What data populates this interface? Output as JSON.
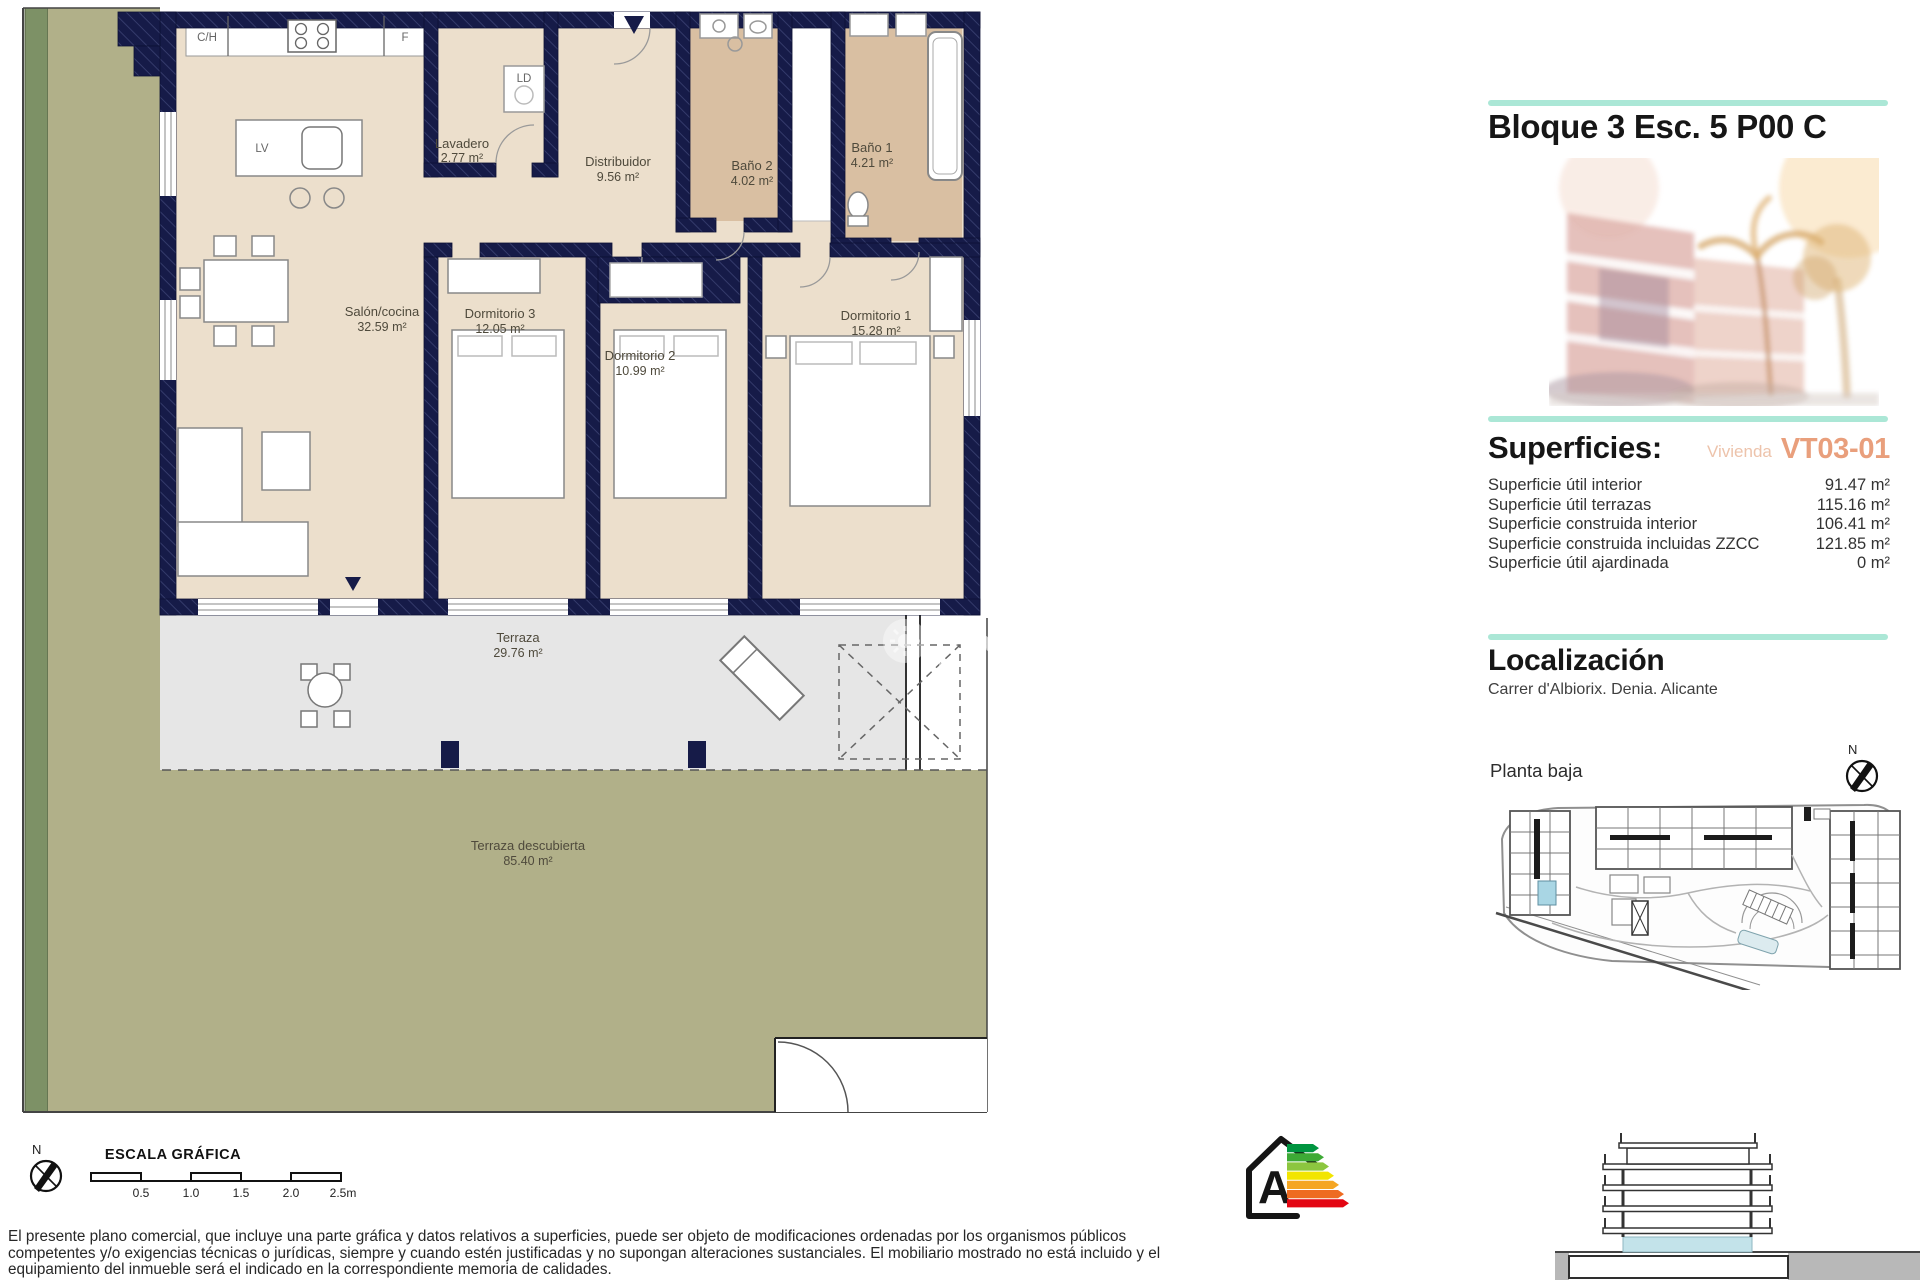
{
  "plan": {
    "rooms": [
      {
        "label": "Salón/cocina",
        "area": "32.59 m²"
      },
      {
        "label": "Dormitorio 3",
        "area": "12.05 m²"
      },
      {
        "label": "Dormitorio 2",
        "area": "10.99 m²"
      },
      {
        "label": "Dormitorio 1",
        "area": "15.28 m²"
      },
      {
        "label": "Lavadero",
        "area": "2.77 m²"
      },
      {
        "label": "Distribuidor",
        "area": "9.56 m²"
      },
      {
        "label": "Baño 2",
        "area": "4.02 m²"
      },
      {
        "label": "Baño 1",
        "area": "4.21 m²"
      },
      {
        "label": "Terraza",
        "area": "29.76 m²"
      },
      {
        "label": "Terraza descubierta",
        "area": "85.40 m²"
      }
    ],
    "kitchen_labels": {
      "ch": "C/H",
      "f": "F",
      "lv": "LV",
      "ld": "LD"
    },
    "north_label": "N"
  },
  "sidebar": {
    "title": "Bloque 3 Esc. 5 P00 C",
    "superficies": {
      "heading": "Superficies:",
      "vivienda_label": "Vivienda",
      "vivienda_code": "VT03-01",
      "rows": [
        {
          "label": "Superficie útil interior",
          "value": "91.47 m²"
        },
        {
          "label": "Superficie útil terrazas",
          "value": "115.16 m²"
        },
        {
          "label": "Superficie construida interior",
          "value": "106.41 m²"
        },
        {
          "label": "Superficie construida incluidas ZZCC",
          "value": "121.85 m²"
        },
        {
          "label": "Superficie útil ajardinada",
          "value": "0 m²"
        }
      ]
    },
    "localizacion": {
      "heading": "Localización",
      "address": "Carrer d'Albiorix. Denia. Alicante"
    }
  },
  "siteplan": {
    "caption": "Planta baja",
    "north_label": "N"
  },
  "footer": {
    "escala_heading": "ESCALA GRÁFICA",
    "scale_ticks": [
      "0.5",
      "1.0",
      "1.5",
      "2.0",
      "2.5m"
    ],
    "north_label": "N",
    "disclaimer_lines": [
      "El presente plano comercial, que incluye una parte gráfica y datos relativos a superficies, puede ser objeto de modificaciones ordenadas por los organismos públicos",
      "competentes y/o exigencias técnicas o jurídicas, siempre y cuando estén justificadas y no supongan alteraciones sustanciales. El mobiliario mostrado no está incluido y el",
      "equipamiento del inmueble será el indicado en la correspondiente memoria de calidades."
    ],
    "energy_letter": "A"
  },
  "watermark": {
    "line1": "Ova",
    "line2": "Propert"
  },
  "colors": {
    "accent_cyan": "#abe7d6",
    "accent_salmon": "#e99f7c",
    "wall_navy": "#161b48",
    "garden_olive": "#b1b089",
    "hedge_green": "#7d9166",
    "terrace_grey": "#e6e6e6",
    "interior_beige": "#ecdfcc",
    "bath_tan": "#d9bfa2",
    "highlight_unit_blue": "#a9d6e4",
    "energy_bar_colors": [
      "#009540",
      "#3daa35",
      "#8cc63f",
      "#f2e500",
      "#f5a623",
      "#ee6b21",
      "#e30613"
    ]
  }
}
